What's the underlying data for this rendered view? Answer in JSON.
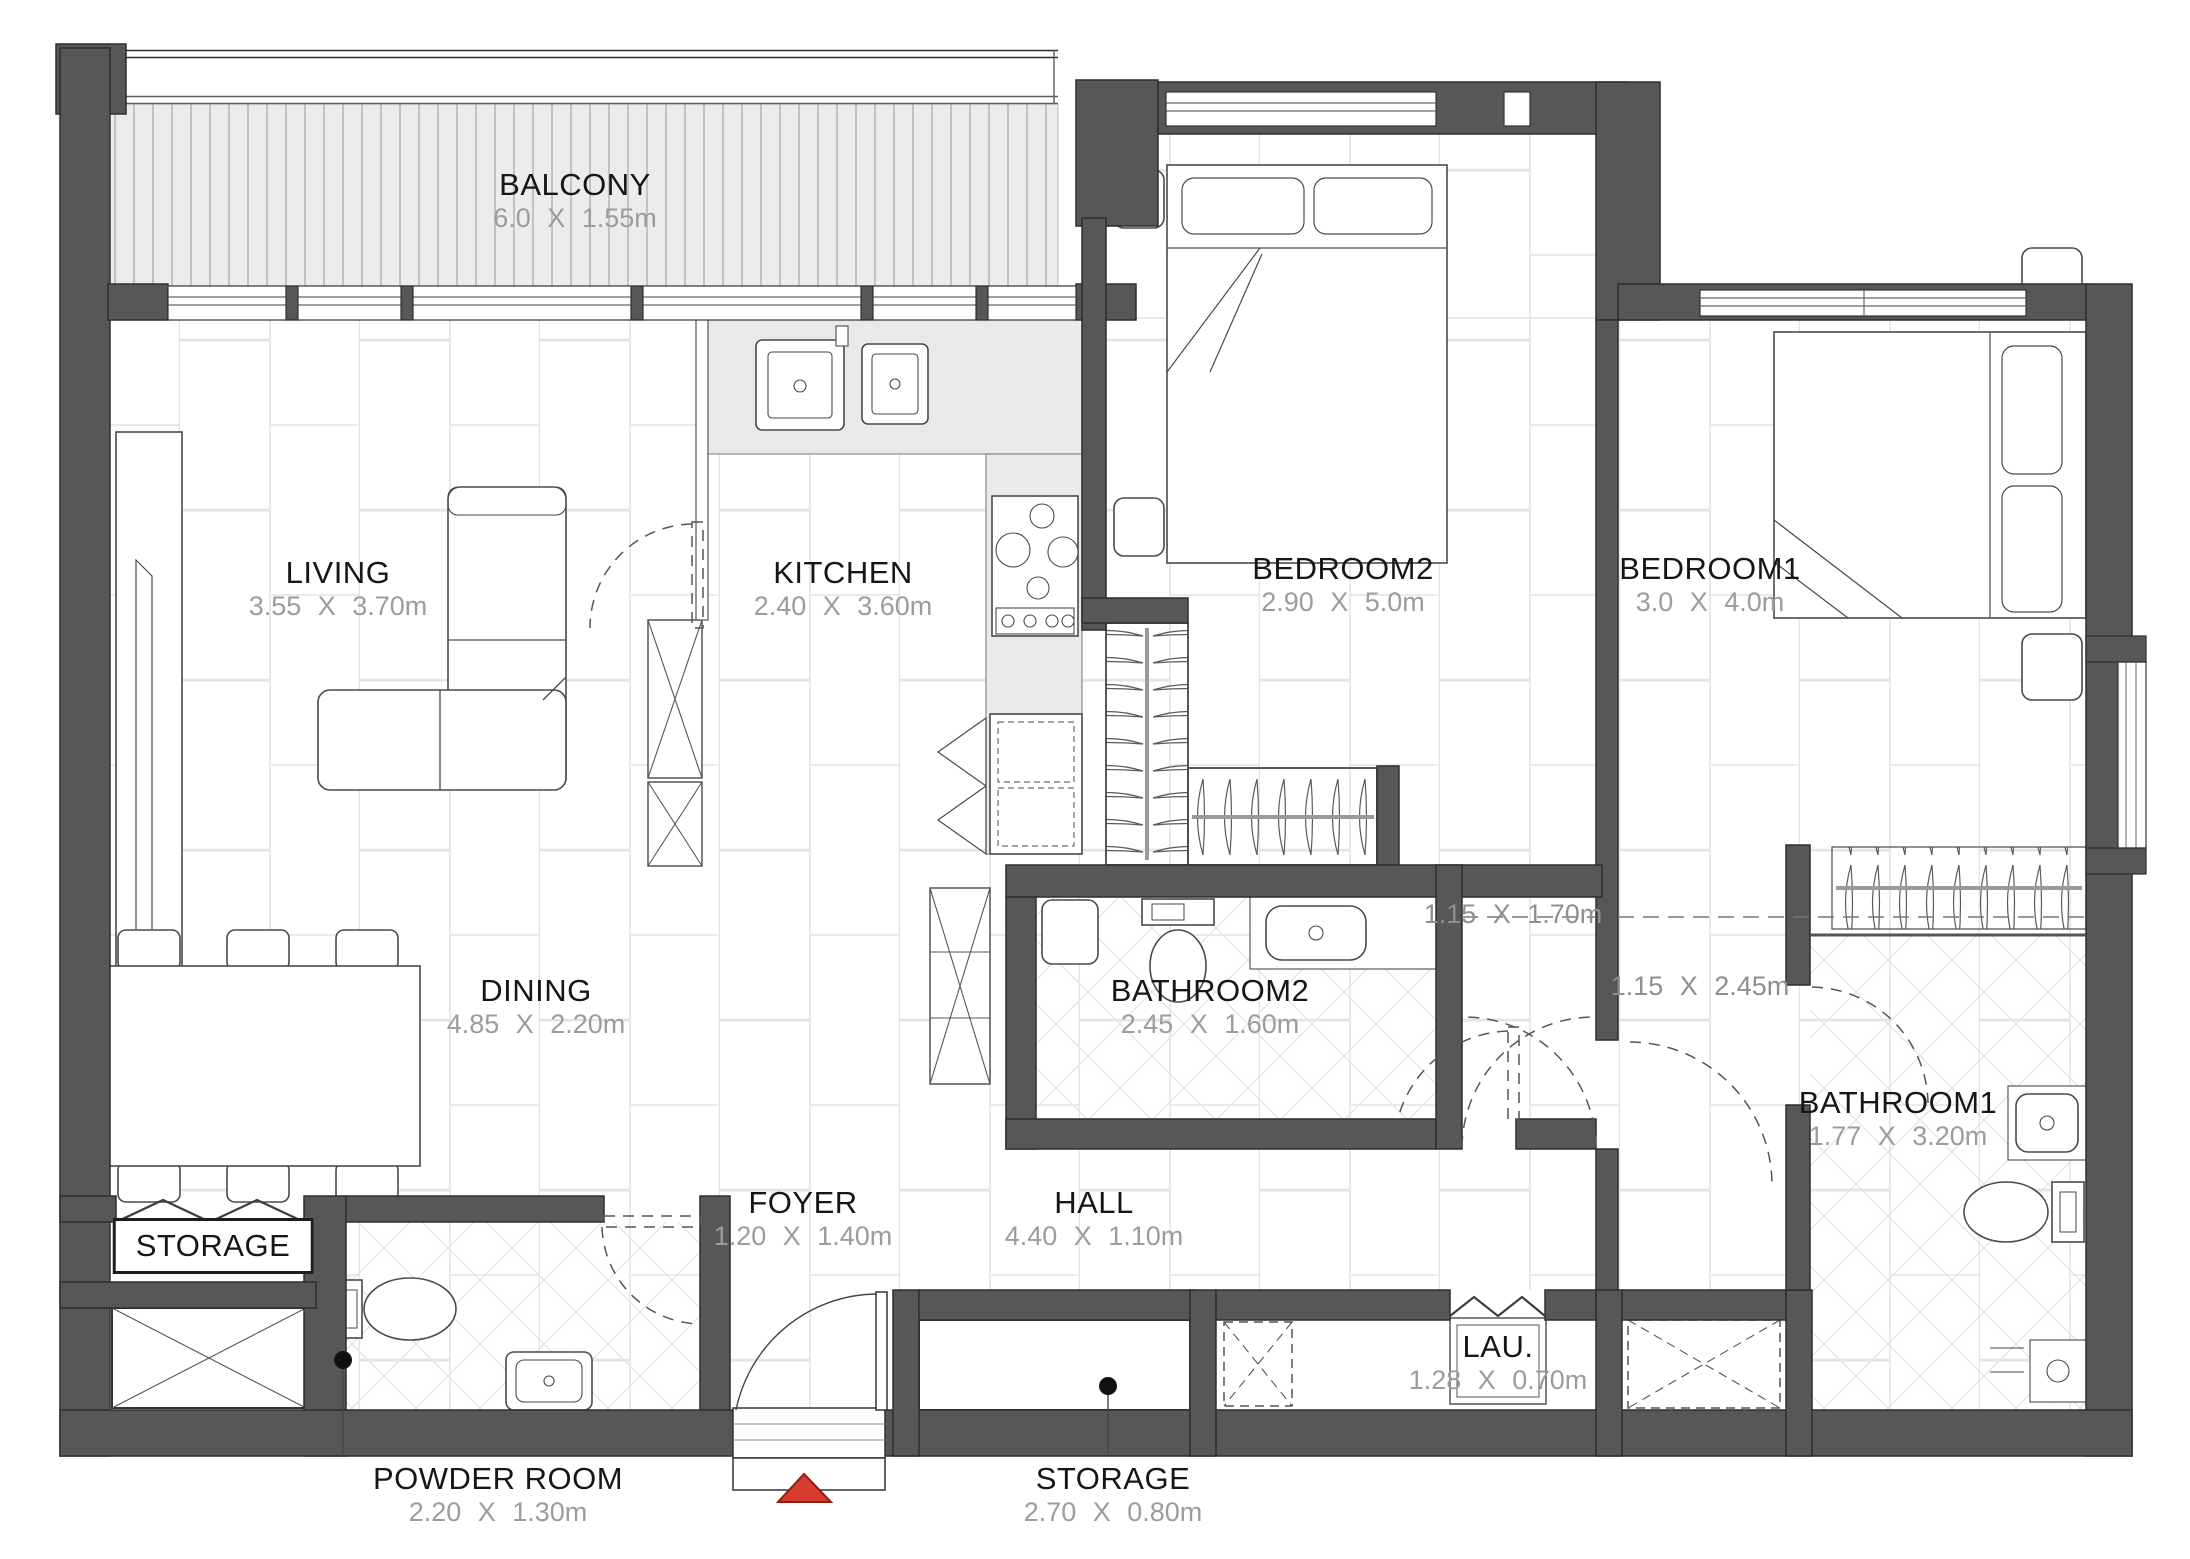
{
  "title": "Apartment Floor Plan",
  "labels": {
    "balcony": {
      "name": "BALCONY",
      "dims": "6.0 X 1.55m"
    },
    "living": {
      "name": "LIVING",
      "dims": "3.55 X 3.70m"
    },
    "kitchen": {
      "name": "KITCHEN",
      "dims": "2.40 X 3.60m"
    },
    "bedroom2": {
      "name": "BEDROOM2",
      "dims": "2.90 X 5.0m"
    },
    "bedroom1": {
      "name": "BEDROOM1",
      "dims": "3.0 X 4.0m"
    },
    "dining": {
      "name": "DINING",
      "dims": "4.85 X 2.20m"
    },
    "bathroom2": {
      "name": "BATHROOM2",
      "dims": "2.45 X 1.60m"
    },
    "bathroom1": {
      "name": "BATHROOM1",
      "dims": "1.77 X 3.20m"
    },
    "storage_left": {
      "name": "STORAGE",
      "dims": ""
    },
    "foyer": {
      "name": "FOYER",
      "dims": "1.20 X 1.40m"
    },
    "hall": {
      "name": "HALL",
      "dims": "4.40 X 1.10m"
    },
    "laundry": {
      "name": "LAU.",
      "dims": "1.28 X 0.70m"
    },
    "powder_room": {
      "name": "POWDER ROOM",
      "dims": "2.20 X 1.30m"
    },
    "storage_bottom": {
      "name": "STORAGE",
      "dims": "2.70 X 0.80m"
    },
    "nook1": {
      "dims": "1.15 X 1.70m"
    },
    "nook2": {
      "dims": "1.15 X 2.45m"
    }
  },
  "markers": {
    "entry_arrow": "red-triangle-up"
  },
  "colors": {
    "wall": "#575757",
    "wall_edge": "#333333",
    "tile_line": "#e6e3e0",
    "diamond_line": "#e4e4e4",
    "deck_fill": "#ececec",
    "deck_stripe": "#c2c2c2",
    "counter_fill": "#e9e9e9",
    "furniture_stroke": "#4a4a4a",
    "room_name_text": "#161616",
    "dimension_text": "#9c9c9c",
    "entry_arrow_fill": "#d63c2f",
    "entry_arrow_edge": "#8e1f14"
  }
}
